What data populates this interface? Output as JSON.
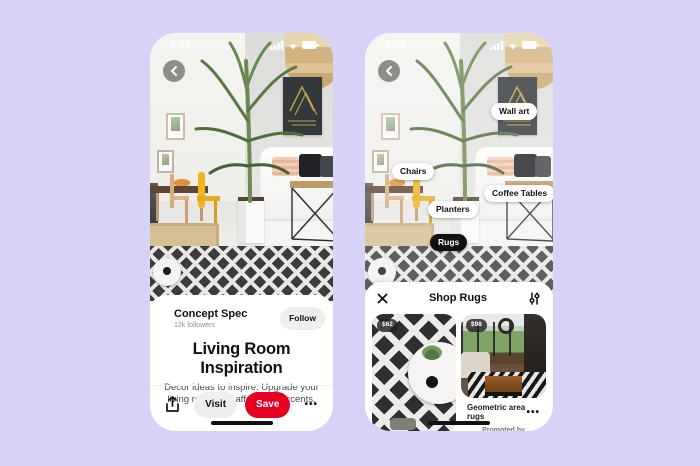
{
  "canvas": {
    "background": "#d8d2f7",
    "accent_red": "#e60023"
  },
  "icons": {
    "back": "chevron-left",
    "share": "share-up-arrow",
    "more": "•••",
    "close": "✕",
    "filter": "vertical-sliders",
    "status": [
      "signal-bars",
      "wifi",
      "battery"
    ]
  },
  "left_phone": {
    "status": {
      "time": "8:08"
    },
    "creator": {
      "name": "Concept Spec",
      "followers": "12k followers",
      "follow_label": "Follow"
    },
    "pin": {
      "title": "Living Room Inspiration",
      "description": "Decor ideas to inspire. Upgrade your living room with affordable accents."
    },
    "actions": {
      "visit_label": "Visit",
      "save_label": "Save",
      "more_label": "•••"
    }
  },
  "right_phone": {
    "status": {
      "time": "8:08"
    },
    "tags": [
      "Wall art",
      "Chairs",
      "Coffee Tables",
      "Planters",
      "Rugs"
    ],
    "sheet": {
      "title": "Shop Rugs",
      "products": [
        {
          "price": "$62"
        },
        {
          "price": "$98",
          "name": "Geometric area rugs",
          "promoted_label": "Promoted by",
          "promoter": "Home Universal",
          "more_label": "•••"
        }
      ]
    }
  }
}
